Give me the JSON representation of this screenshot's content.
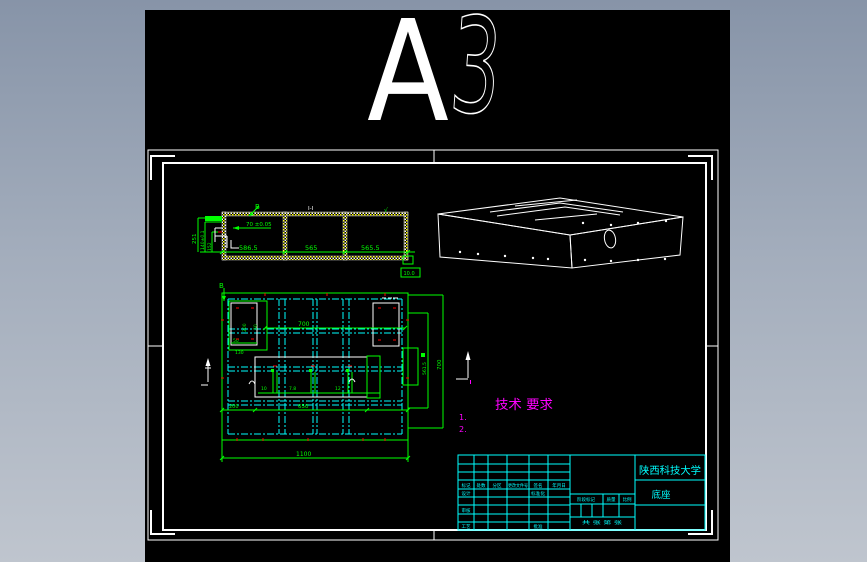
{
  "logo": {
    "size_label_a": "A",
    "size_label_3": "3"
  },
  "section_view": {
    "view_label": "I-I",
    "dim_bottom_1": "586.5",
    "dim_bottom_2": "565",
    "dim_bottom_3": "565.5",
    "dim_left_1": "251",
    "dim_left_2": "140±0.1",
    "dim_left_3": "152",
    "dim_top": "70 ±0.05",
    "surface_finish": "√",
    "note_box": "10.0",
    "section_arrow_label": "B"
  },
  "plan_view": {
    "dim_top": "700",
    "dim_bottom_left": "200",
    "dim_bottom_mid": "650",
    "dim_total": "1100",
    "dim_right_inner": "561.5",
    "dim_right_outer": "700",
    "dim_rect_height": "200",
    "dim_rect_offset": "50",
    "dim_rect_b1": "50",
    "dim_rect_b2": "130",
    "rib_dim_1": "10",
    "rib_dim_2": "7.8",
    "rib_dim_3": "12",
    "section_arrow_label": "B"
  },
  "tech_req": {
    "title": "技术 要求",
    "item_1": "1.",
    "item_2": "2."
  },
  "title_block": {
    "school": "陕西科技大学",
    "part_name": "底座",
    "rev_headers": [
      "标记",
      "处数",
      "分区",
      "更改文件号",
      "签名",
      "年月日"
    ],
    "role_design": "设计",
    "role_standard": "标准化",
    "role_check": "审核",
    "role_process": "工艺",
    "role_approve": "批准",
    "stage_label": "阶段标记",
    "weight_label": "质量",
    "scale_label": "比例",
    "sheet_label": "共 张 第 张"
  },
  "colors": {
    "line_green": "#00ff00",
    "line_cyan": "#00ffff",
    "line_magenta": "#ff00ff",
    "line_red": "#ff0000",
    "line_white": "#ffffff",
    "hatch_yellow": "#ffff00"
  }
}
